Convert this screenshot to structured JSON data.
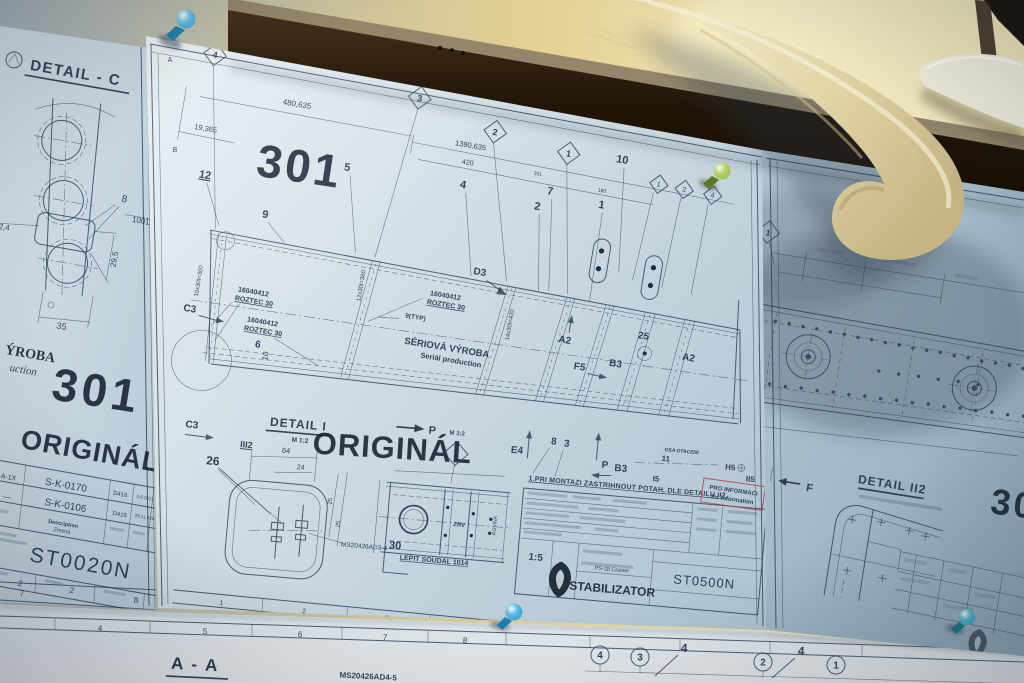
{
  "meta": {
    "description": "Photograph of aircraft stabilizer engineering blueprints pinned to a wooden board"
  },
  "colors": {
    "red_stamp": "#b8373d",
    "ink": "#2b3c50",
    "wall": "#e3d093",
    "wood": "#241709",
    "paper": "#cfdde6"
  },
  "left_sheet": {
    "detail_title": "DETAIL - C",
    "dim_phi": "Ø2,4",
    "dim_8": "8",
    "dim_10013": "10013",
    "dim_29_5": "29,5",
    "dim_35": "35",
    "stamp_partial_1": "ÝROBA",
    "stamp_partial_2": "uction",
    "stamp_number": "301",
    "stamp_original": "ORIGINÁL",
    "rev_rows": [
      [
        "A-1X",
        "S-K-0170",
        "D416",
        "3.6.2011"
      ],
      [
        "—",
        "S-K-0106",
        "D416",
        "29.11.2010"
      ]
    ],
    "header_description": "Description",
    "header_zmena": "Zmena",
    "drawing_number": "ST0020N",
    "footer_sheets": "2",
    "footer_sheet": "2",
    "border_7": "7",
    "border_8": "8"
  },
  "center_sheet": {
    "zone_a": "A",
    "zone_b": "B",
    "diamonds": [
      "4",
      "3",
      "2",
      "1"
    ],
    "small_diamonds": [
      "1",
      "2",
      "4"
    ],
    "stamp_number": "301",
    "stamp_original": "ORIGINÁL",
    "dim_19365": "19,365",
    "dim_480635": "480,635",
    "dim_1390635": "1390,635",
    "dim_420": "420",
    "dim_331": "331",
    "dim_180": "180",
    "items": {
      "i12": "12",
      "i9": "9",
      "i5": "5",
      "i4": "4",
      "i7": "7",
      "i2": "2",
      "i1": "1",
      "i10": "10",
      "i6": "6",
      "i10b": "10",
      "i26": "26",
      "i25": "25",
      "i11": "11",
      "i8": "8",
      "i3": "3"
    },
    "part_no": "16040412",
    "roztec": "ROZTEC 30",
    "typ": "9(TYP)",
    "pitch_1": "10x30t=300",
    "pitch_2": "12x30t=360",
    "pitch_3": "14x30t=420",
    "seriova_1": "SÉRIOVÁ VÝROBA",
    "seriova_2": "Seriál production",
    "zones": {
      "c3": "C3",
      "d3": "D3",
      "a2": "A2",
      "f5": "F5",
      "b3": "B3",
      "e4": "E4",
      "h5": "H5",
      "i5": "I5",
      "ii5": "II5",
      "iii2": "III2",
      "p": "P"
    },
    "detail_i": "DETAIL I",
    "scale_m12": "M 1:2",
    "dim_64": "64",
    "dim_24": "24",
    "dim_25": "25",
    "ms_part": "MS20426AD3-4",
    "glue_num": "30",
    "glue_note": "LEPIT SOUDAL 1014",
    "zrv": "ZRV",
    "rovina": "ROVINA",
    "osa": "OSA OTACENI",
    "note": "1.PRI MONTAZI ZASTRIHNOUT POTAH, DLE DETAILU II2.",
    "scale_15": "1:5",
    "aircraft": "PS-28 Cruiser",
    "part_name": "STABILIZATOR",
    "doc_number": "ST0500N",
    "red_stamp_1": "PRO INFORMACI",
    "red_stamp_2": "for information",
    "border_nums": [
      "1",
      "2",
      "3",
      "4",
      "5"
    ]
  },
  "right_sheet": {
    "diamond": "1",
    "detail_title": "DETAIL II2",
    "stamp_number": "301",
    "zone_f": "F"
  },
  "bottom_sheets": {
    "border_nums": [
      "4",
      "5",
      "6",
      "7",
      "8"
    ],
    "section": "A - A",
    "ms_part": "MS20426AD4-5",
    "circled": [
      "4",
      "3",
      "2",
      "1"
    ],
    "leader": "4"
  },
  "pins": {
    "top_blue": "#3fa8d8",
    "green": "#9fc03c",
    "bottom_blue": "#2ea1d4",
    "teal": "#2aa6c0"
  }
}
